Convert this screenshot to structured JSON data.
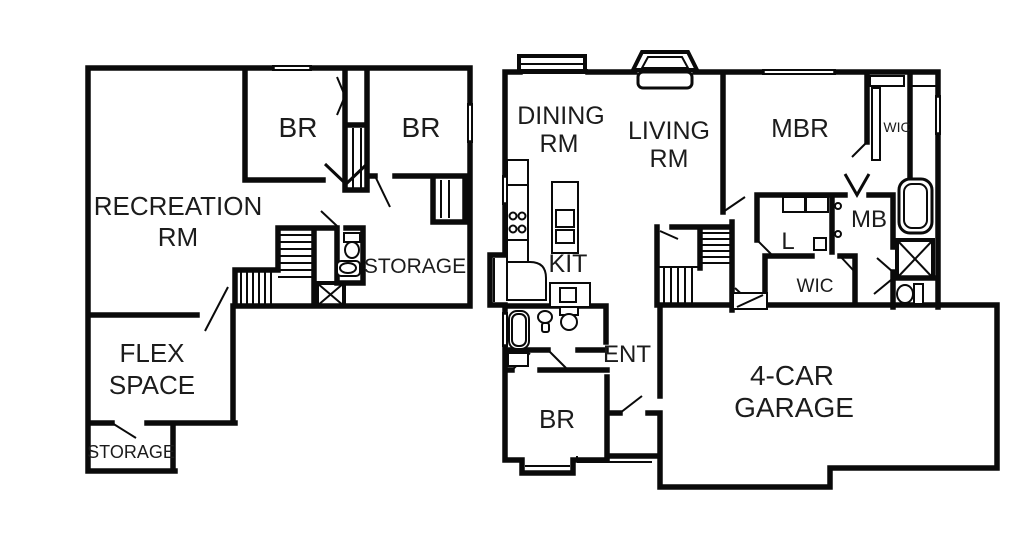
{
  "canvas": {
    "background": "#ffffff",
    "line_color": "#0a0a0a",
    "text_color": "#1c1c1c"
  },
  "plans": {
    "lower": {
      "rooms": {
        "recreation": {
          "line1": "RECREATION",
          "line2": "RM"
        },
        "bedroom_left": {
          "label": "BR"
        },
        "bedroom_right": {
          "label": "BR"
        },
        "storage": {
          "label": "STORAGE"
        },
        "flex": {
          "line1": "FLEX",
          "line2": "SPACE"
        },
        "storage_small": {
          "label": "STORAGE"
        }
      }
    },
    "main": {
      "rooms": {
        "dining": {
          "line1": "DINING",
          "line2": "RM"
        },
        "living": {
          "line1": "LIVING",
          "line2": "RM"
        },
        "master_bedroom": {
          "label": "MBR"
        },
        "wic_master": {
          "label": "WIC"
        },
        "kitchen": {
          "label": "KIT"
        },
        "master_bath": {
          "label": "MB"
        },
        "laundry": {
          "label": "L"
        },
        "wic_hall": {
          "label": "WIC"
        },
        "entry": {
          "label": "ENT"
        },
        "bedroom": {
          "label": "BR"
        },
        "garage": {
          "line1": "4-CAR",
          "line2": "GARAGE"
        }
      }
    }
  }
}
